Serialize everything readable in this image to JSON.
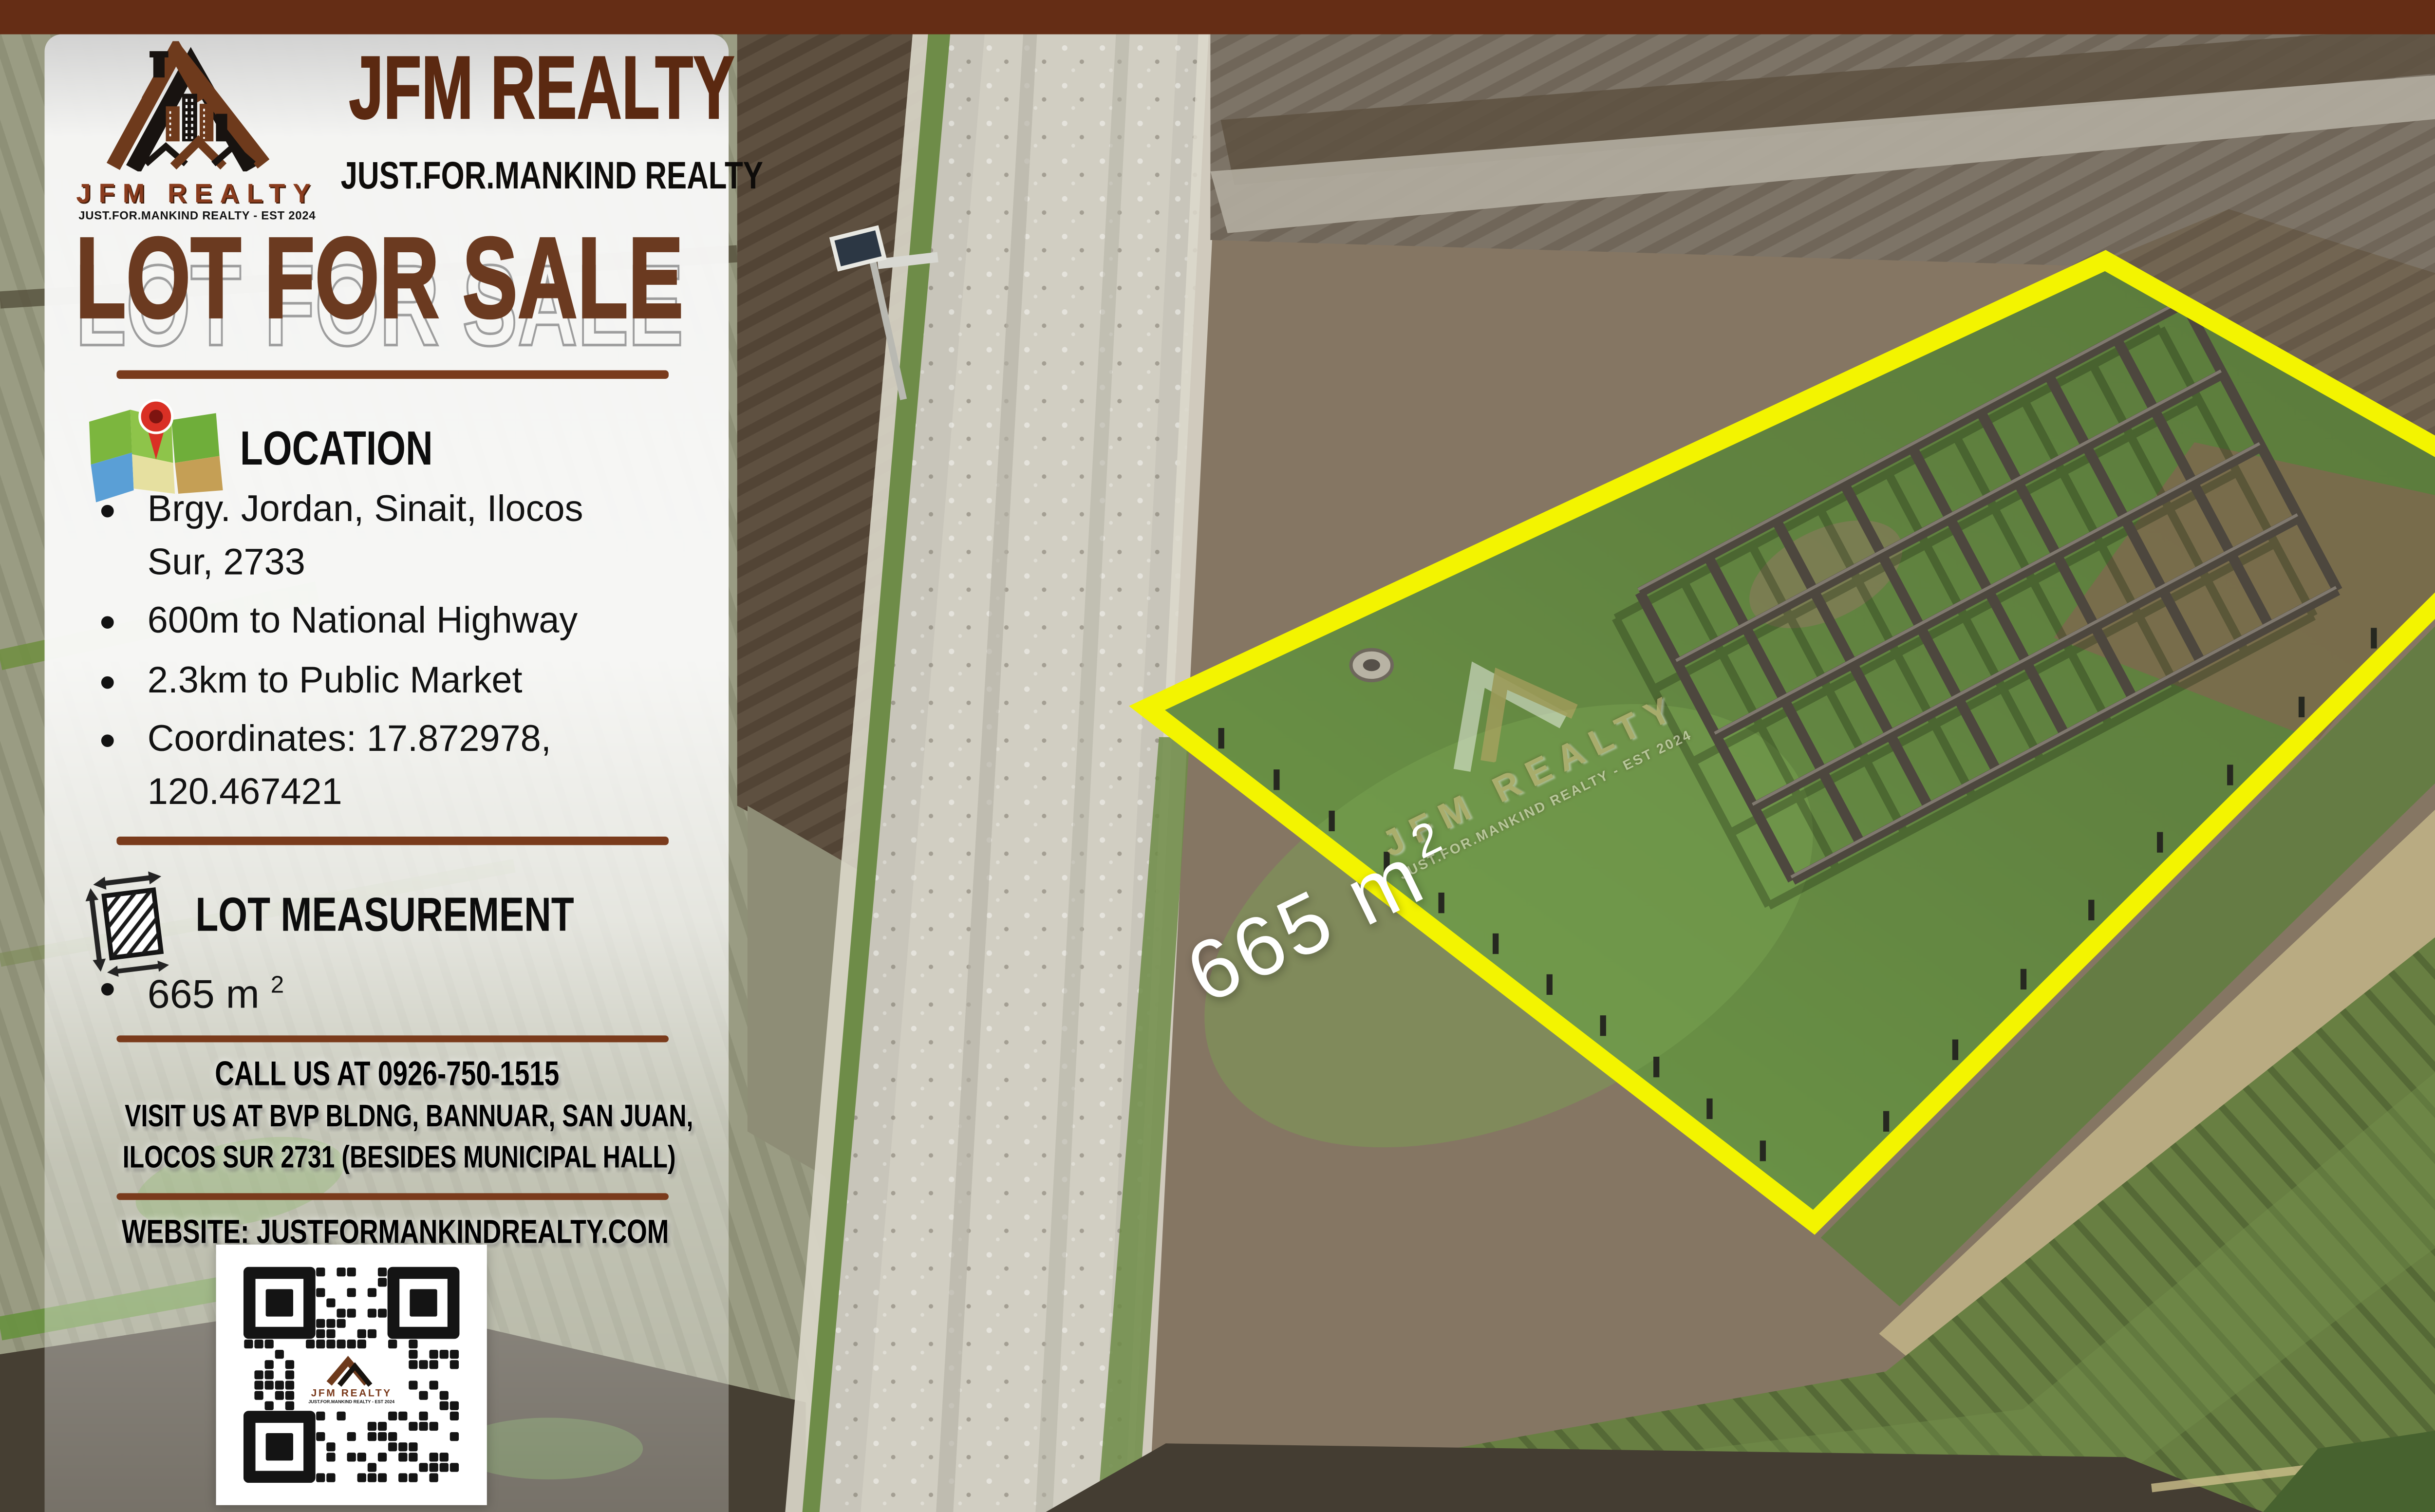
{
  "colors": {
    "band_brown": "#652d15",
    "title_brown": "#5b2911",
    "headline_brown": "#6b3a20",
    "divider_brown": "#7a3b1c",
    "lot_outline_yellow": "#f3f400"
  },
  "brand": {
    "logo_name": "JFM REALTY",
    "logo_tagline": "JUST.FOR.MANKIND REALTY - EST 2024",
    "title": "JFM REALTY",
    "subtitle": "JUST.FOR.MANKIND REALTY"
  },
  "poster": {
    "headline": "LOT FOR SALE",
    "location": {
      "title": "LOCATION",
      "items": [
        "Brgy. Jordan, Sinait, Ilocos Sur, 2733",
        "600m to National Highway",
        "2.3km to Public Market",
        "Coordinates: 17.872978, 120.467421"
      ]
    },
    "measurement": {
      "title": "LOT MEASUREMENT",
      "area_value": "665 m",
      "area_exponent": "2"
    },
    "contact": {
      "call": "CALL US AT 0926-750-1515",
      "visit_line1": "VISIT US AT BVP BLDNG, BANNUAR, SAN JUAN,",
      "visit_line2": "ILOCOS SUR 2731 (BESIDES MUNICIPAL HALL)",
      "website": "WEBSITE: JUSTFORMANKINDREALTY.COM"
    }
  },
  "photo": {
    "area_value": "665 m",
    "area_exponent": "2"
  },
  "watermark": {
    "title": "JFM REALTY",
    "tagline": "JUST.FOR.MANKIND REALTY - EST 2024"
  },
  "qr": {
    "center_title": "JFM REALTY",
    "center_tagline": "JUST.FOR.MANKIND REALTY - EST 2024"
  }
}
